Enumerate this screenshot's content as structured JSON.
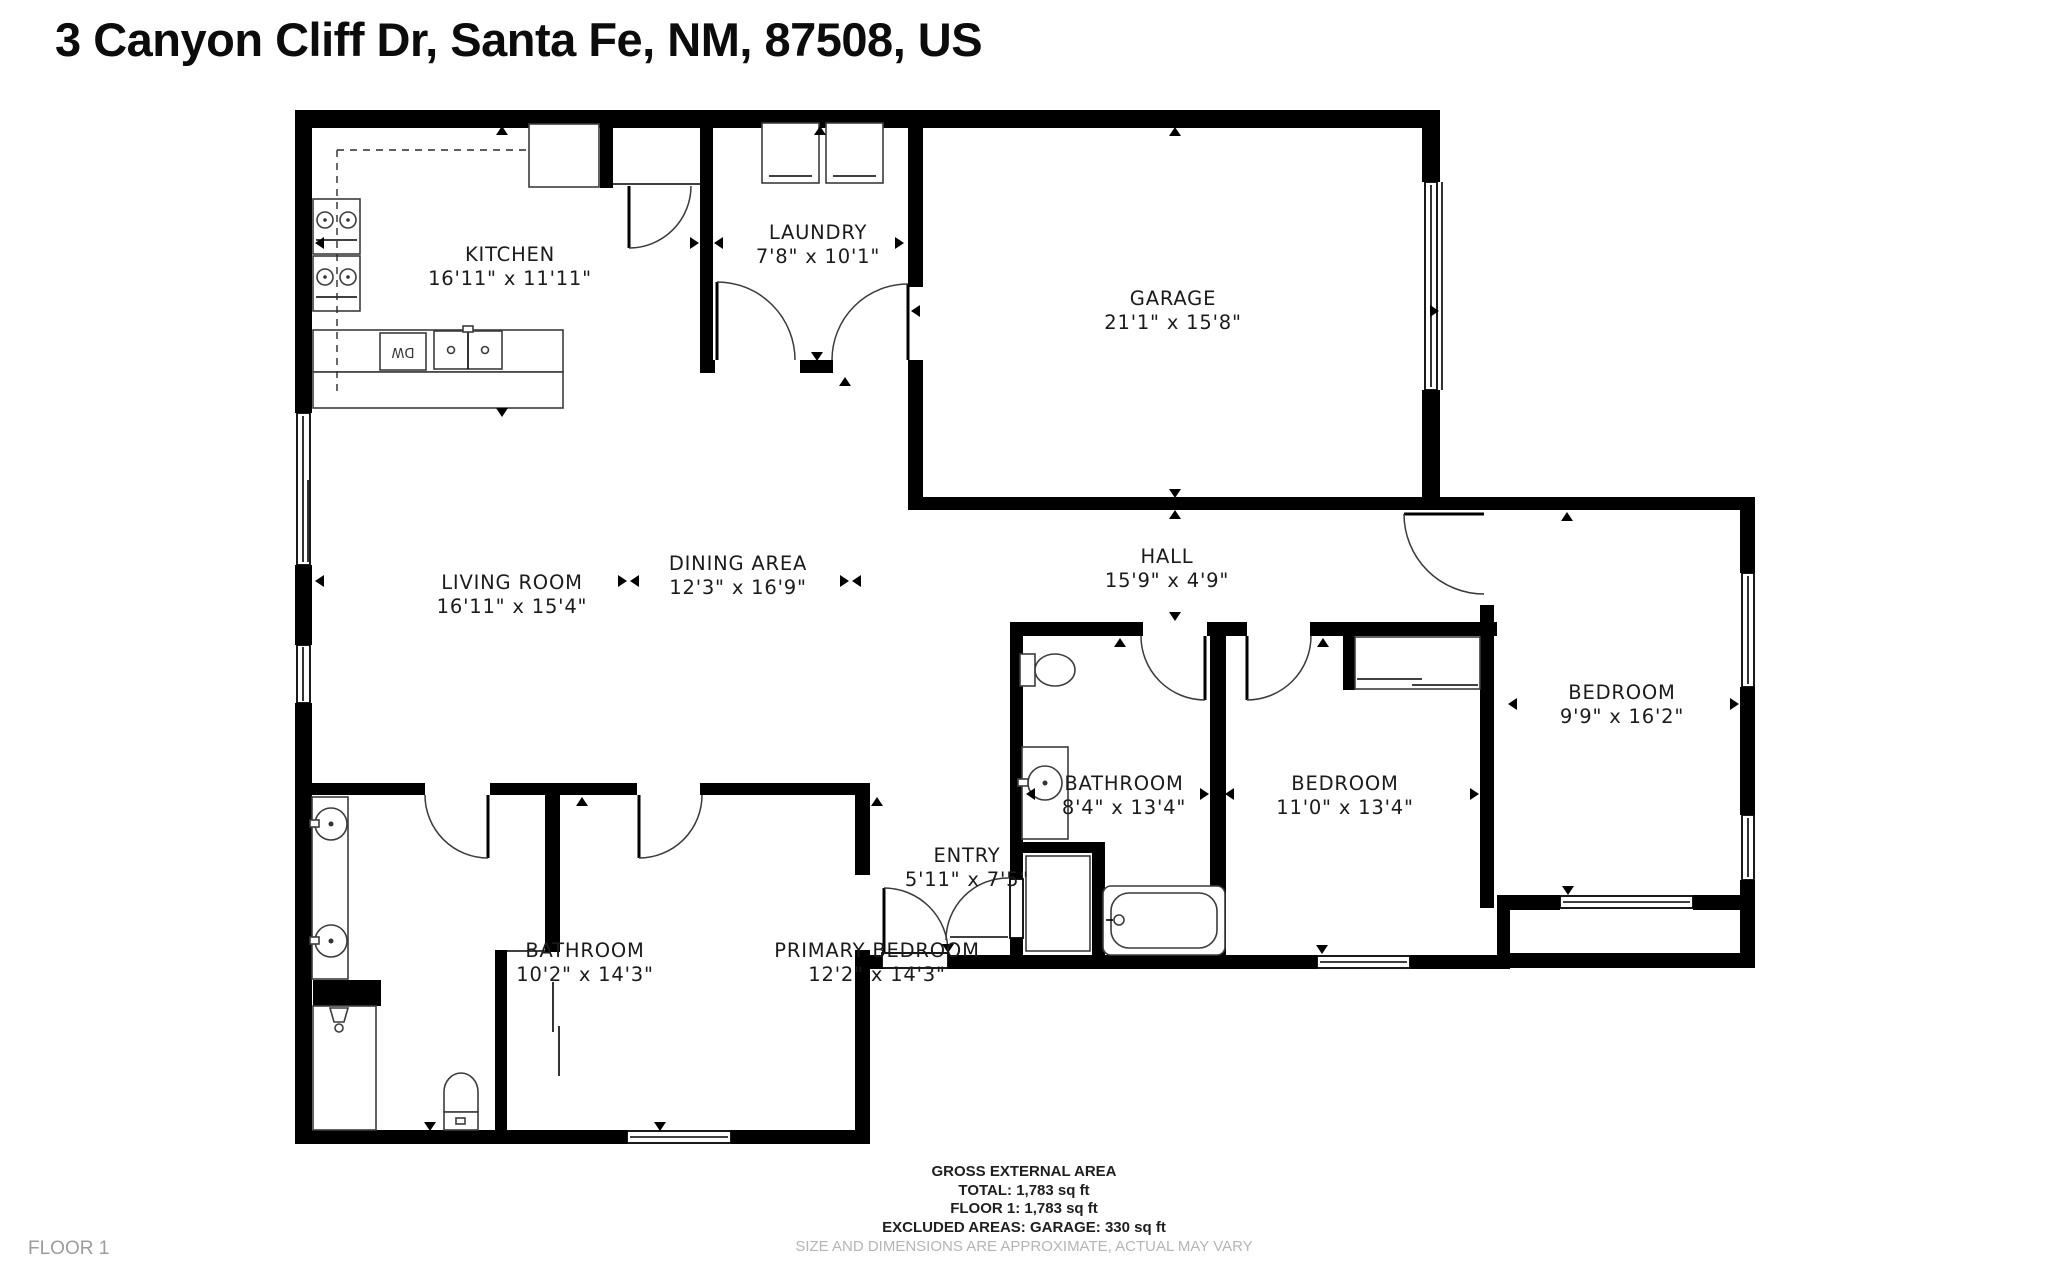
{
  "title": "3 Canyon Cliff Dr, Santa Fe, NM, 87508, US",
  "floor_label": "FLOOR 1",
  "rooms": {
    "kitchen": {
      "name": "KITCHEN",
      "dims": "16'11\" x 11'11\""
    },
    "laundry": {
      "name": "LAUNDRY",
      "dims": "7'8\" x 10'1\""
    },
    "garage": {
      "name": "GARAGE",
      "dims": "21'1\" x 15'8\""
    },
    "living_room": {
      "name": "LIVING ROOM",
      "dims": "16'11\" x 15'4\""
    },
    "dining_area": {
      "name": "DINING AREA",
      "dims": "12'3\" x 16'9\""
    },
    "hall": {
      "name": "HALL",
      "dims": "15'9\" x 4'9\""
    },
    "bedroom_right": {
      "name": "BEDROOM",
      "dims": "9'9\" x 16'2\""
    },
    "bathroom_middle": {
      "name": "BATHROOM",
      "dims": "8'4\" x 13'4\""
    },
    "bedroom_middle": {
      "name": "BEDROOM",
      "dims": "11'0\" x 13'4\""
    },
    "entry": {
      "name": "ENTRY",
      "dims": "5'11\" x 7'5\""
    },
    "bathroom_left": {
      "name": "BATHROOM",
      "dims": "10'2\" x 14'3\""
    },
    "primary_bedroom": {
      "name": "PRIMARY BEDROOM",
      "dims": "12'2\" x 14'3\""
    }
  },
  "fixtures": {
    "dishwasher_label": "DW"
  },
  "footer": {
    "heading": "GROSS EXTERNAL AREA",
    "total": "TOTAL: 1,783 sq ft",
    "floor1": "FLOOR 1: 1,783 sq ft",
    "excluded": "EXCLUDED AREAS: GARAGE: 330 sq ft",
    "disclaimer": "SIZE AND DIMENSIONS ARE APPROXIMATE, ACTUAL MAY VARY"
  },
  "colors": {
    "walls": "#000000",
    "label_text": "#1b1b1b",
    "muted_text": "#b5b5b5",
    "background": "#ffffff"
  }
}
